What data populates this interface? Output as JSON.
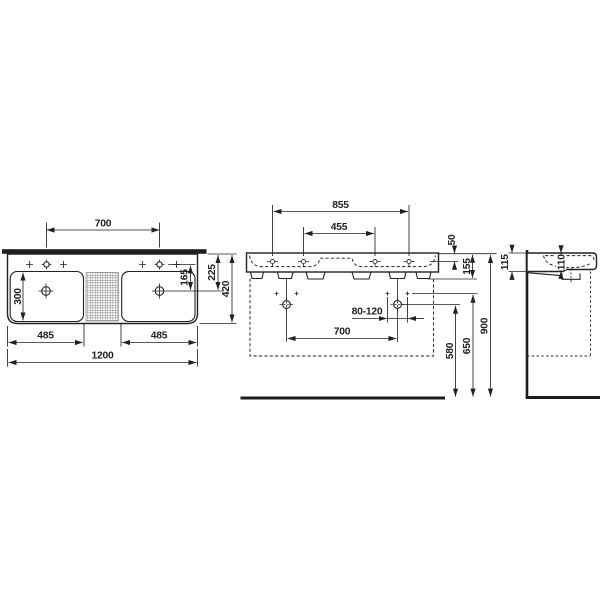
{
  "drawing": {
    "title": "double-washbasin-technical-drawing",
    "units": "mm",
    "colors": {
      "line": "#222222",
      "background": "#ffffff",
      "hatch": "#979797"
    },
    "plan": {
      "tap_hole_spacing": "700",
      "bowl_depth": "300",
      "tap_to_drain": "165",
      "back_to_drain": "225",
      "total_depth": "420",
      "bowl_width_left": "485",
      "bowl_width_right": "485",
      "total_width": "1200"
    },
    "front": {
      "outer_tap_holes": "855",
      "inner_tap_holes": "455",
      "rim_to_tap_hole": "50",
      "front_edge_height": "155",
      "fixing_hole_range": "80-120",
      "fixing_bolt_spacing": "700",
      "outlet_height": "580",
      "fixing_bolt_height": "650",
      "rim_height": "900"
    },
    "side": {
      "height_at_wall": "115",
      "basin_height_front": "110"
    }
  }
}
